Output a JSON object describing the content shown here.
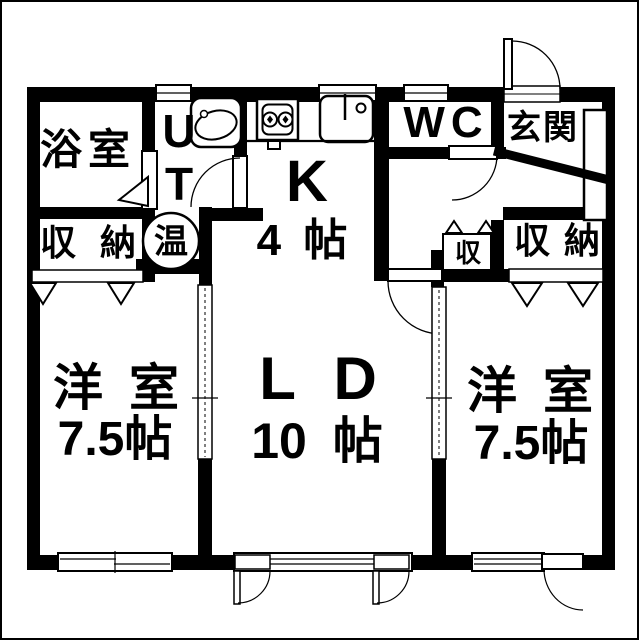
{
  "plan_title": "apartment-floor-plan",
  "rooms": {
    "bathroom": {
      "label": "浴室"
    },
    "utility": {
      "label_top": "U",
      "label_bottom": "T"
    },
    "water_heater": {
      "label": "温"
    },
    "closet_left": {
      "label": "収 納"
    },
    "kitchen": {
      "label": "K",
      "size": "4 帖"
    },
    "wc": {
      "label": "WC"
    },
    "entrance": {
      "label": "玄関"
    },
    "closet_hall": {
      "label": "収"
    },
    "closet_right": {
      "label": "収 納"
    },
    "living_dining": {
      "label": "L D",
      "size": "10 帖"
    },
    "western_room_left": {
      "label": "洋 室",
      "size": "7.5帖"
    },
    "western_room_right": {
      "label": "洋 室",
      "size": "7.5帖"
    }
  },
  "colors": {
    "wall": "#000000",
    "floor": "#ffffff"
  }
}
